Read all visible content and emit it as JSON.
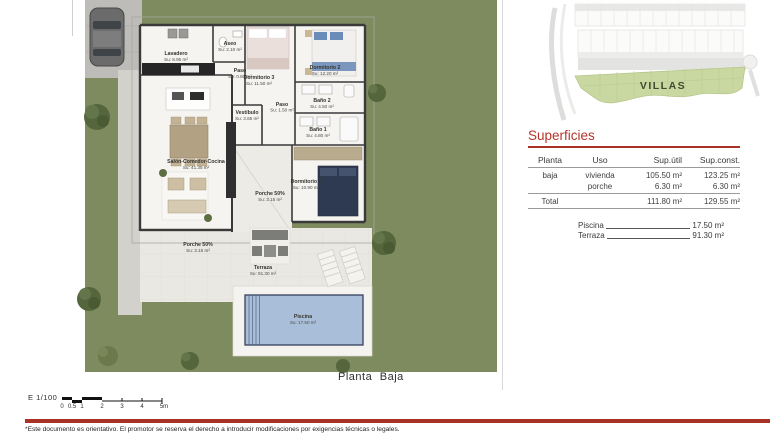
{
  "page": {
    "caption": "Planta Baja",
    "scale_label": "E 1/100",
    "scale_ticks": [
      "0",
      "0.5",
      "1",
      "2",
      "3",
      "4",
      "5m"
    ],
    "disclaimer": "*Este documento es orientativo. El promotor se reserva el derecho a introducir modificaciones por exigencias técnicas o legales."
  },
  "site_plan": {
    "zone_label": "VILLAS"
  },
  "superficies": {
    "title": "Superficies",
    "headers": [
      "Planta",
      "Uso",
      "Sup.útil",
      "Sup.const."
    ],
    "rows": [
      {
        "planta": "baja",
        "uso": "vivienda",
        "sup_util": "105.50 m²",
        "sup_const": "123.25 m²"
      },
      {
        "planta": "",
        "uso": "porche",
        "sup_util": "6.30 m²",
        "sup_const": "6.30 m²"
      }
    ],
    "total": {
      "label": "Total",
      "sup_util": "111.80 m²",
      "sup_const": "129.55 m²"
    },
    "extras": [
      {
        "label": "Piscina",
        "value": "17.50 m²"
      },
      {
        "label": "Terraza",
        "value": "91.30 m²"
      }
    ]
  },
  "rooms": [
    {
      "name": "Lavadero",
      "area": "Su: 8.95 m²"
    },
    {
      "name": "Aseo",
      "area": "Su: 2.10 m²"
    },
    {
      "name": "Paso",
      "area": "Su: 0.80 m²"
    },
    {
      "name": "Dormitorio 3",
      "area": "Su: 11.50 m²"
    },
    {
      "name": "Dormitorio 2",
      "area": "Su: 12.20 m²"
    },
    {
      "name": "Baño 2",
      "area": "Su: 4.50 m²"
    },
    {
      "name": "Paso",
      "area": "Su: 1.50 m²"
    },
    {
      "name": "Baño 1",
      "area": "Su: 4.80 m²"
    },
    {
      "name": "Vestíbulo",
      "area": "Su: 3.65 m²"
    },
    {
      "name": "Salón-Comedor-Cocina",
      "area": "Su: 41.35 m²"
    },
    {
      "name": "Dormitorio 1",
      "area": "Su: 10.90 m²"
    },
    {
      "name": "Porche 50%",
      "area": "Su: 3.15 m²"
    },
    {
      "name": "Porche 50%",
      "area": "Su: 3.15 m²"
    },
    {
      "name": "Terraza",
      "area": "Su: 91.30 m²"
    },
    {
      "name": "Piscina",
      "area": "Su: 17.50 m²"
    }
  ],
  "colors": {
    "accent_red": "#a93226",
    "garden_green": "#7d8b5e",
    "villas_green": "#c9d8a0",
    "pool_blue": "#a9bed8",
    "wall_dark": "#3a3a3a"
  }
}
